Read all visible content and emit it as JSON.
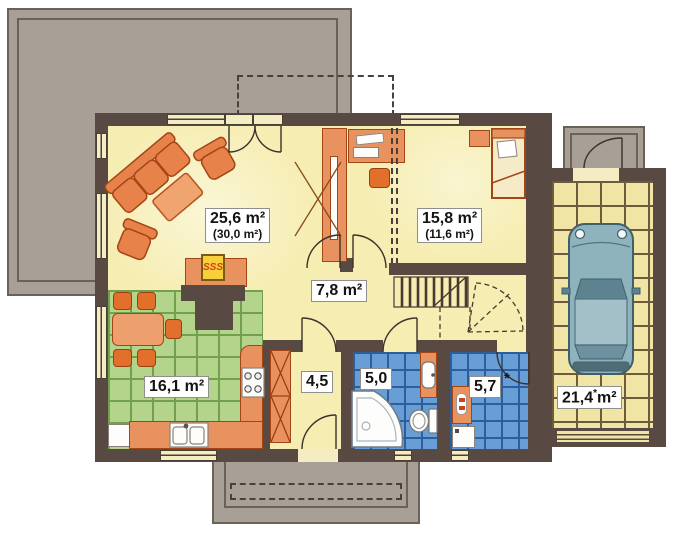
{
  "labels": {
    "living": {
      "main": "25,6 m²",
      "alt": "(30,0 m²)"
    },
    "bedroom": {
      "main": "15,8 m²",
      "alt": "(11,6 m²)"
    },
    "hall": {
      "main": "7,8 m²"
    },
    "kitchen": {
      "main": "16,1 m²"
    },
    "vestibule": {
      "main": "4,5"
    },
    "bathroom": {
      "main": "5,0"
    },
    "utility": {
      "main": "5,7",
      "star": "*"
    },
    "garage": {
      "value": "21,4",
      "star": "*",
      "unit": "m²"
    }
  },
  "icons": {
    "fireplace_flames": "SSS"
  },
  "colors": {
    "wall": "#584a42",
    "floor": "#f6edb2",
    "kitchen_tile": "#b4d48c",
    "bathroom_tile": "#689ed6",
    "garage_tile": "#f1e5a5",
    "furniture_orange": "#e8935f",
    "terrace_gray": "#a8a096",
    "car_body": "#8fb3bd"
  }
}
